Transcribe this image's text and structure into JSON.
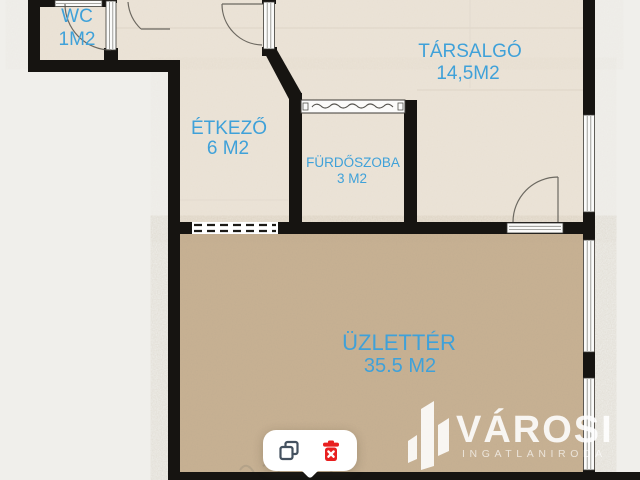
{
  "rooms": {
    "wc": {
      "name": "WC",
      "area": "1M2"
    },
    "tarsalgo": {
      "name": "TÁRSALGÓ",
      "area": "14,5M2"
    },
    "etkezo": {
      "name": "ÉTKEZŐ",
      "area": "6 M2"
    },
    "furdoszoba": {
      "name": "FÜRDŐSZOBA",
      "area": "3 M2"
    },
    "uzletter": {
      "name": "ÜZLETTÉR",
      "area": "35.5 M2"
    }
  },
  "logo": {
    "name": "VÁROSI",
    "subtitle": "INGATLANIRODA"
  },
  "toolbar": {
    "buttons": [
      {
        "icon": "copy-icon"
      },
      {
        "icon": "trash-icon"
      }
    ]
  },
  "colors": {
    "label_blue": "#3fa1d9",
    "wall_black": "#161411",
    "floor_upper": "#ece4d8",
    "floor_shop": "#c9b294",
    "outside": "#f0efeb",
    "delete_red": "#e81f1f",
    "copy_gray": "#44515f"
  }
}
